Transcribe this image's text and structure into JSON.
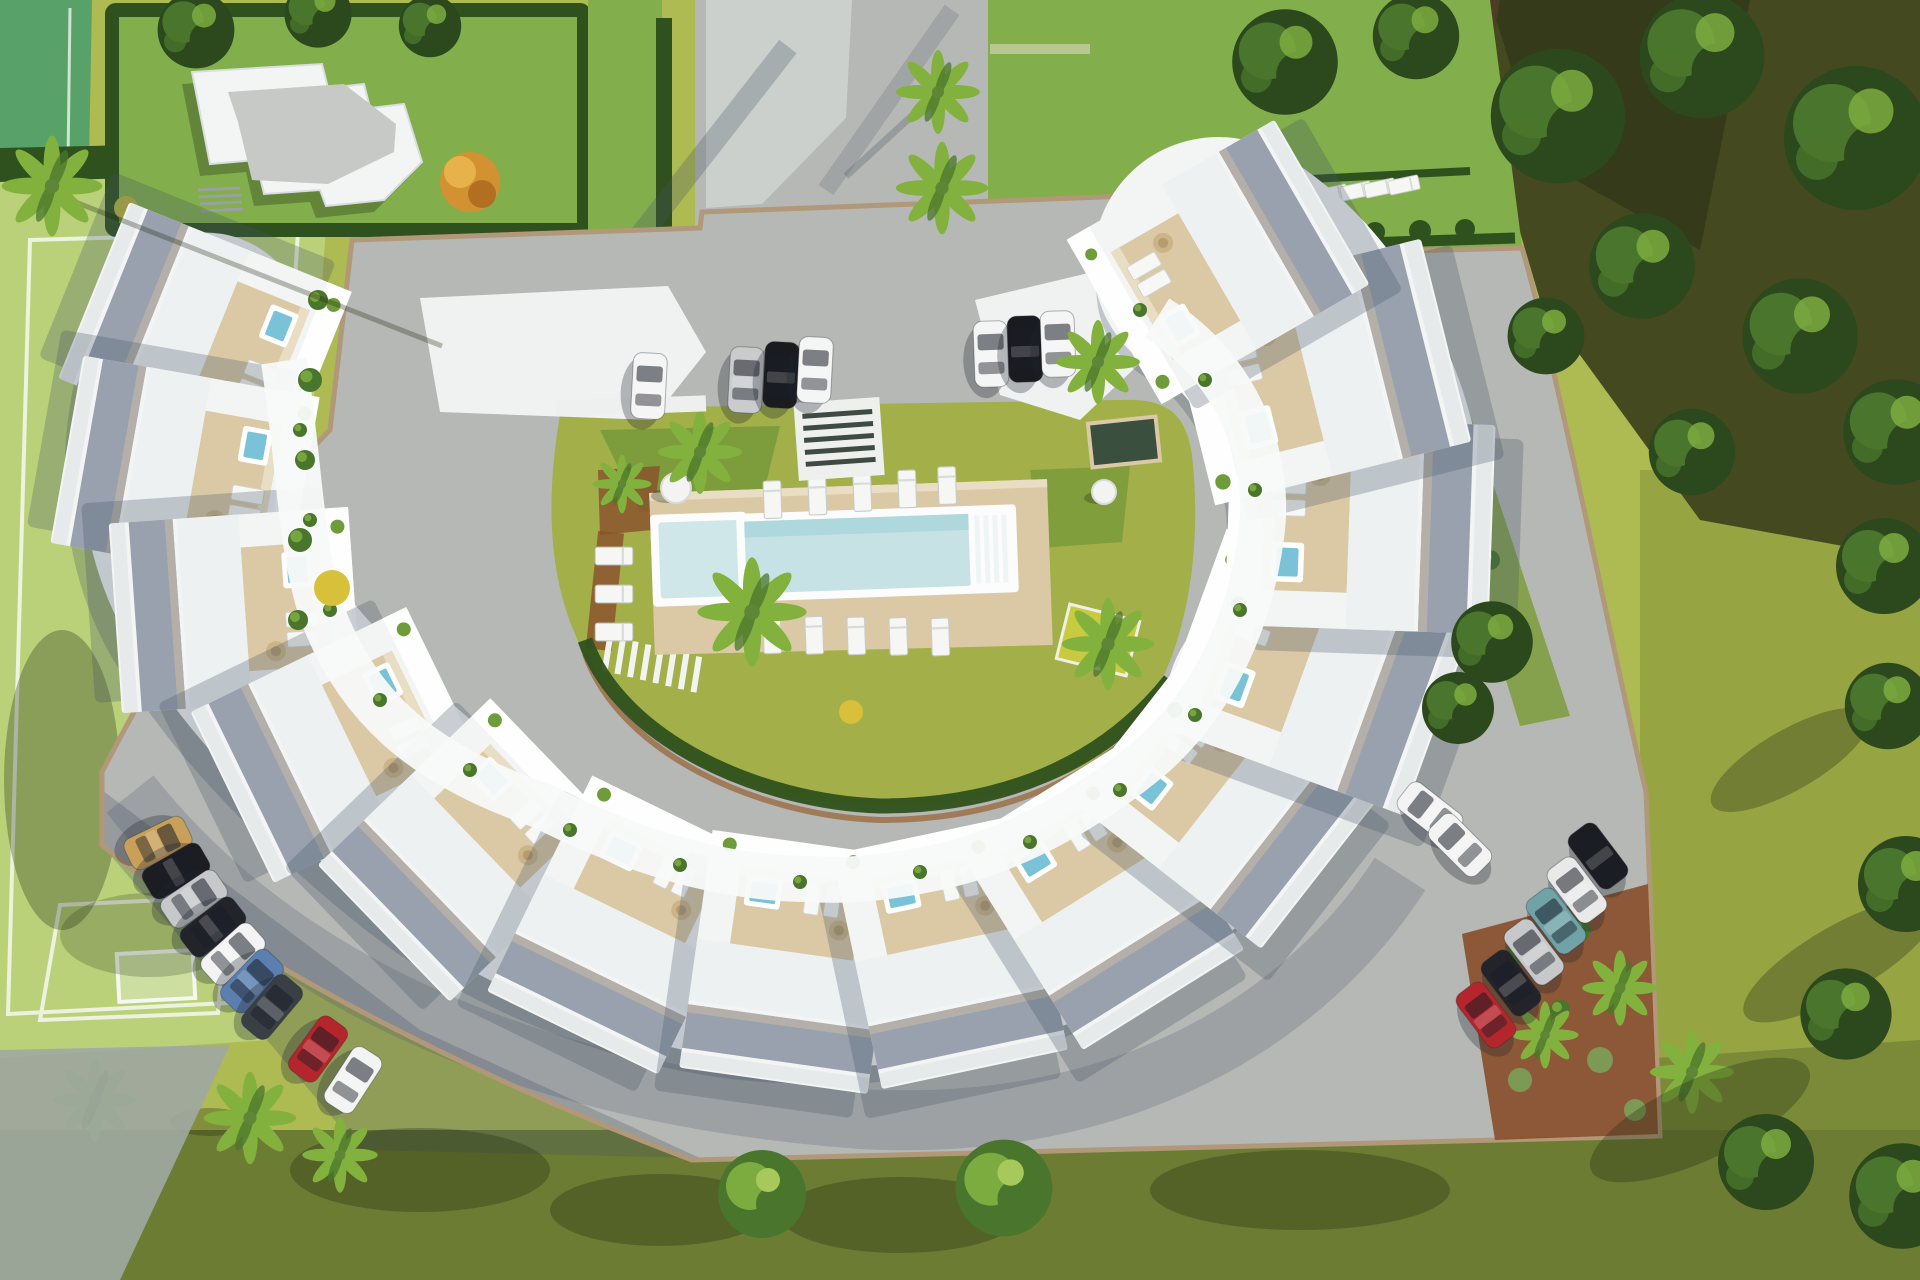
{
  "scene": {
    "type": "aerial-3d-architectural-render",
    "subject": "crescent-shaped white townhouse complex around a courtyard pool, lawns, sports field and parking"
  },
  "palette": {
    "lawn": "#aeba52",
    "lawn-right": "#96a442",
    "lawn-bottom": "#6c7c33",
    "field": "#bad179",
    "court": "#58a169",
    "garden": "#82ae4b",
    "hedge": "#2f511e",
    "tree-dark": "#2c481d",
    "tree-mid": "#4a752c",
    "tree-light": "#7cab3f",
    "palm": "#83b13e",
    "road": "#b6b8b5",
    "concrete": "#ced1cd",
    "wall": "#b09878",
    "building": "#f3f5f5",
    "building-shade": "#dde2e5",
    "terrace": "#f8faf9",
    "deck": "#dbc9a5",
    "deck-light": "#e9ddc3",
    "gravel": "#98a1ad",
    "gravel-light": "#b4b0a9",
    "pool": "#c7e2e4",
    "pool-deep": "#aed8db",
    "jacuzzi": "#7ac2d7",
    "mulch": "#8a4f2d",
    "accent": "#d29231",
    "shadow-green": "rgba(30,40,18,0.30)",
    "shadow-blue": "rgba(70,82,102,0.28)"
  },
  "cars": {
    "top_row": [
      "#f4f5f4",
      "#c9cbcd",
      "#1a1b1f",
      "#f4f5f4",
      "#f4f5f4",
      "#1a1b1f",
      "#f4f5f4"
    ],
    "bottom_left_row": [
      "#c9a05a",
      "#1c1d22",
      "#c6c8ca",
      "#23242a",
      "#f2f3f2",
      "#5b7fae",
      "#3a3f46",
      "#b5252c",
      "#f2f3f2"
    ],
    "bottom_right_row": [
      "#1c1d22",
      "#e8e9e8",
      "#6fa3a8",
      "#c6c8ca",
      "#23242a",
      "#b5252c"
    ],
    "right_cluster": [
      "#f2f3f2",
      "#f2f3f2"
    ]
  },
  "inventory": {
    "townhouse_units": 14,
    "parked_cars": 24,
    "main_pool": 1,
    "kids_pool": 1,
    "rooftop_jacuzzis": 14,
    "football_goal": 1
  }
}
